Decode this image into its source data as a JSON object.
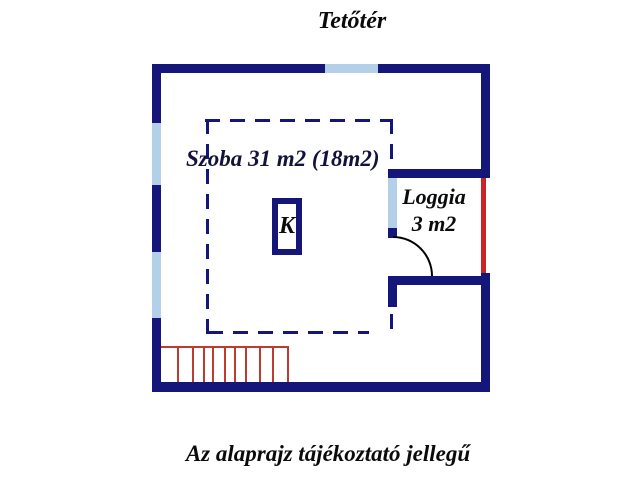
{
  "header": {
    "title": "Tetőtér"
  },
  "plan": {
    "room_label": "Szoba 31 m2 (18m2)",
    "loggia_name": "Loggia",
    "loggia_area": "3 m2",
    "chimney_label": "K"
  },
  "footer": {
    "note": "Az alaprajz tájékoztató jellegű"
  },
  "colors": {
    "wall": "#14167a",
    "window": "#b4cfe8",
    "railing": "#cb2525",
    "stairs": "#be3c2d",
    "door_arc": "#000000",
    "text": "#0b0b0b"
  }
}
